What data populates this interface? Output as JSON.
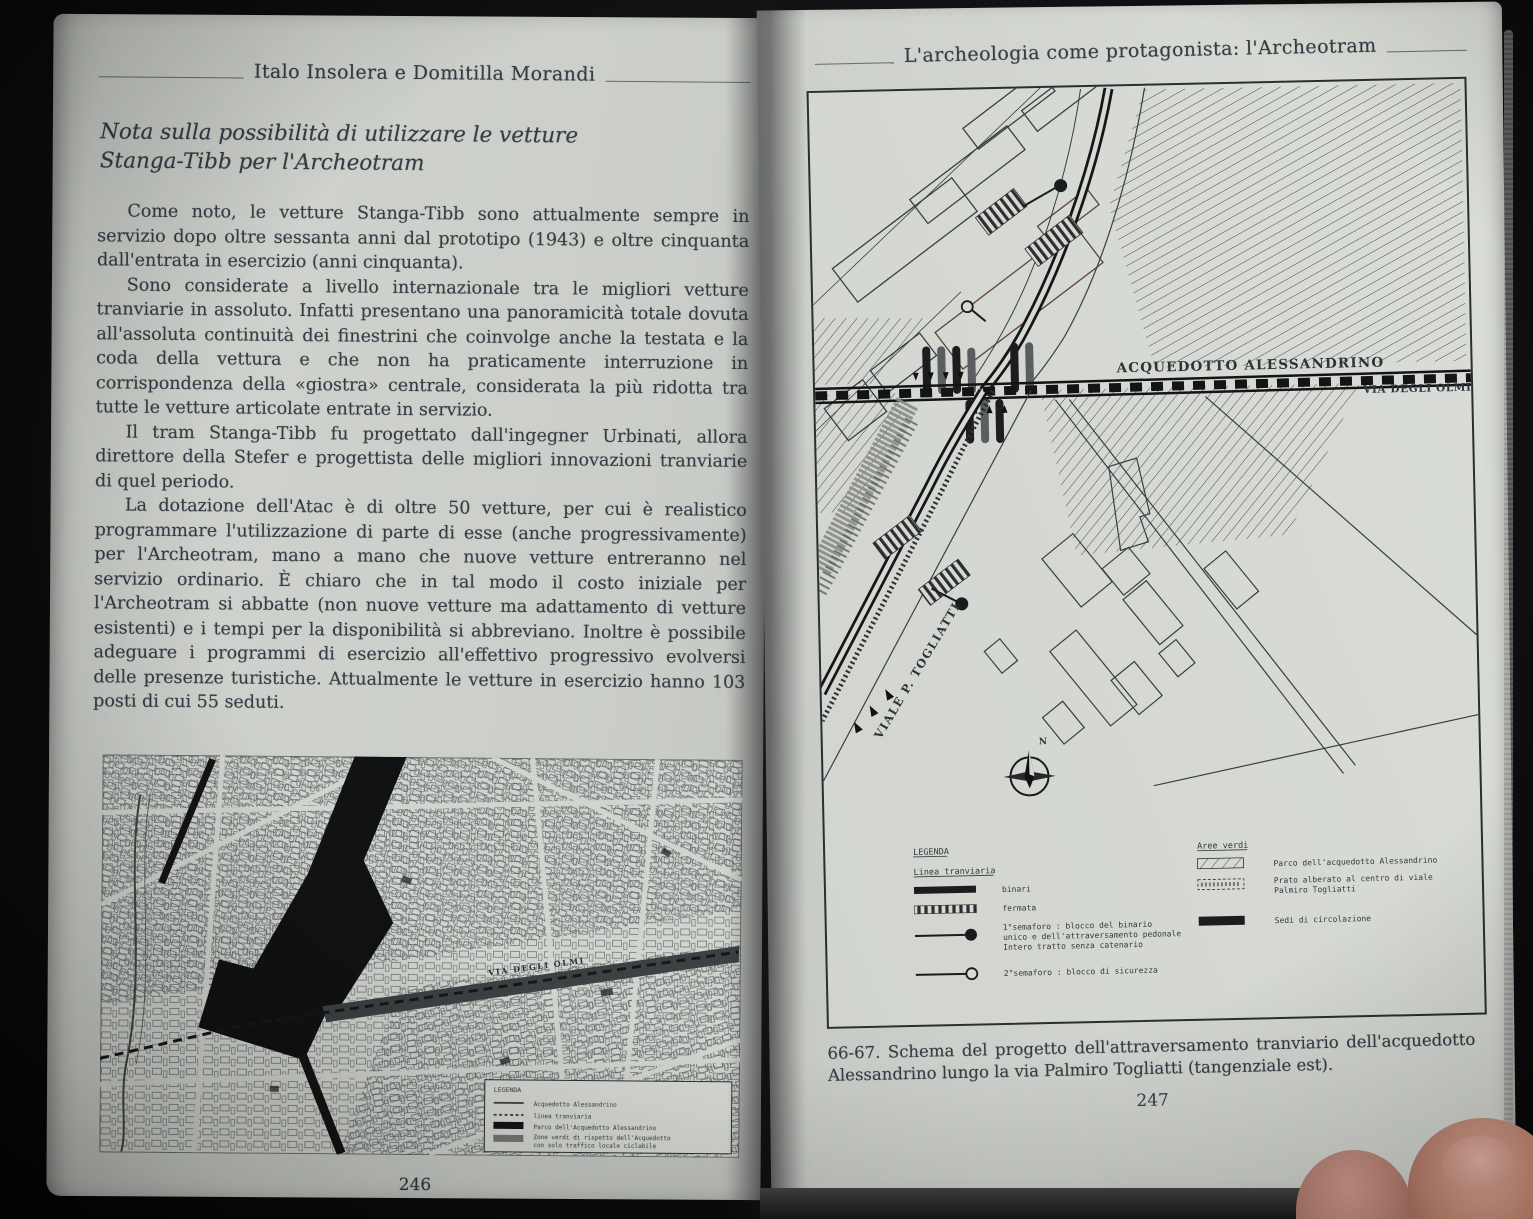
{
  "colors": {
    "page": "#cdd0cb",
    "ink": "#353c44",
    "accent_black": "#141414"
  },
  "left_page": {
    "running_head": "Italo Insolera e Domitilla Morandi",
    "title_line1": "Nota sulla possibilità di utilizzare le vetture",
    "title_line2": "Stanga-Tibb per l'Archeotram",
    "paragraphs": [
      "Come noto, le vetture Stanga-Tibb sono attualmente sempre in servizio dopo oltre sessanta anni dal prototipo (1943) e oltre cinquanta dall'entrata in esercizio (anni cinquanta).",
      "Sono considerate a livello internazionale tra le migliori vetture tranviarie in assoluto. Infatti presentano una panoramicità totale dovuta all'assoluta continuità dei finestrini che coinvolge anche la testata e la coda della vettura e che non ha praticamente interruzione in corrispondenza della «giostra» centrale, considerata la più ridotta tra tutte le vetture articolate entrate in servizio.",
      "Il tram Stanga-Tibb fu progettato dall'ingegner Urbinati, allora direttore della Stefer e progettista delle migliori innovazioni tranviarie di quel periodo.",
      "La dotazione dell'Atac è di oltre 50 vetture, per cui è realistico programmare l'utilizzazione di parte di esse (anche progressivamente) per l'Archeotram, mano a mano che nuove vetture entreranno nel servizio ordinario. È chiaro che in tal modo il costo iniziale per l'Archeotram si abbatte (non nuove vetture ma adattamento di vetture esistenti) e i tempi per la disponibilità si abbreviano. Inoltre è possibile adeguare i programmi di esercizio all'effettivo progressivo evolversi delle presenze turistiche. Attualmente le vetture in esercizio hanno 103 posti di cui 55 seduti."
    ],
    "page_number": "246",
    "map": {
      "street_label": "VIA DEGLI OLMI",
      "legend": {
        "title": "LEGENDA",
        "item1": "Acquedotto Alessandrino",
        "item2": "linea tranviaria",
        "item3": "Parco dell'Acquedotto Alessandrino",
        "item4_l1": "Zone verdi di rispetto dell'Acquedotto",
        "item4_l2": "con solo traffico locale ciclabile"
      }
    }
  },
  "right_page": {
    "running_head": "L'archeologia come protagonista: l'Archeotram",
    "figure": {
      "label_acquedotto": "ACQUEDOTTO ALESSANDRINO",
      "label_via_olmi": "VIA DEGLI OLMI",
      "label_viale_togliatti": "VIALE P. TOGLIATTI",
      "compass_n": "N",
      "legend": {
        "title": "LEGENDA",
        "tram_header": "Linea tranviaria",
        "binari": "binari",
        "fermata": "fermata",
        "sem1_l1": "1°semaforo : blocco del binario",
        "sem1_l2": "unico e dell'attraversamento pedonale",
        "sem1_l3": "Intero tratto senza catenario",
        "sem2": "2°semaforo : blocco di sicurezza",
        "green_header": "Aree verdi",
        "parco": "Parco dell'acquedotto Alessandrino",
        "prato_l1": "Prato alberato al centro di viale",
        "prato_l2": "Palmiro Togliatti",
        "sedi": "Sedi di circolazione"
      }
    },
    "caption": "66-67. Schema del progetto dell'attraversamento tranviario dell'acquedotto Alessandrino lungo la via Palmiro Togliatti (tangenziale est).",
    "page_number": "247"
  }
}
